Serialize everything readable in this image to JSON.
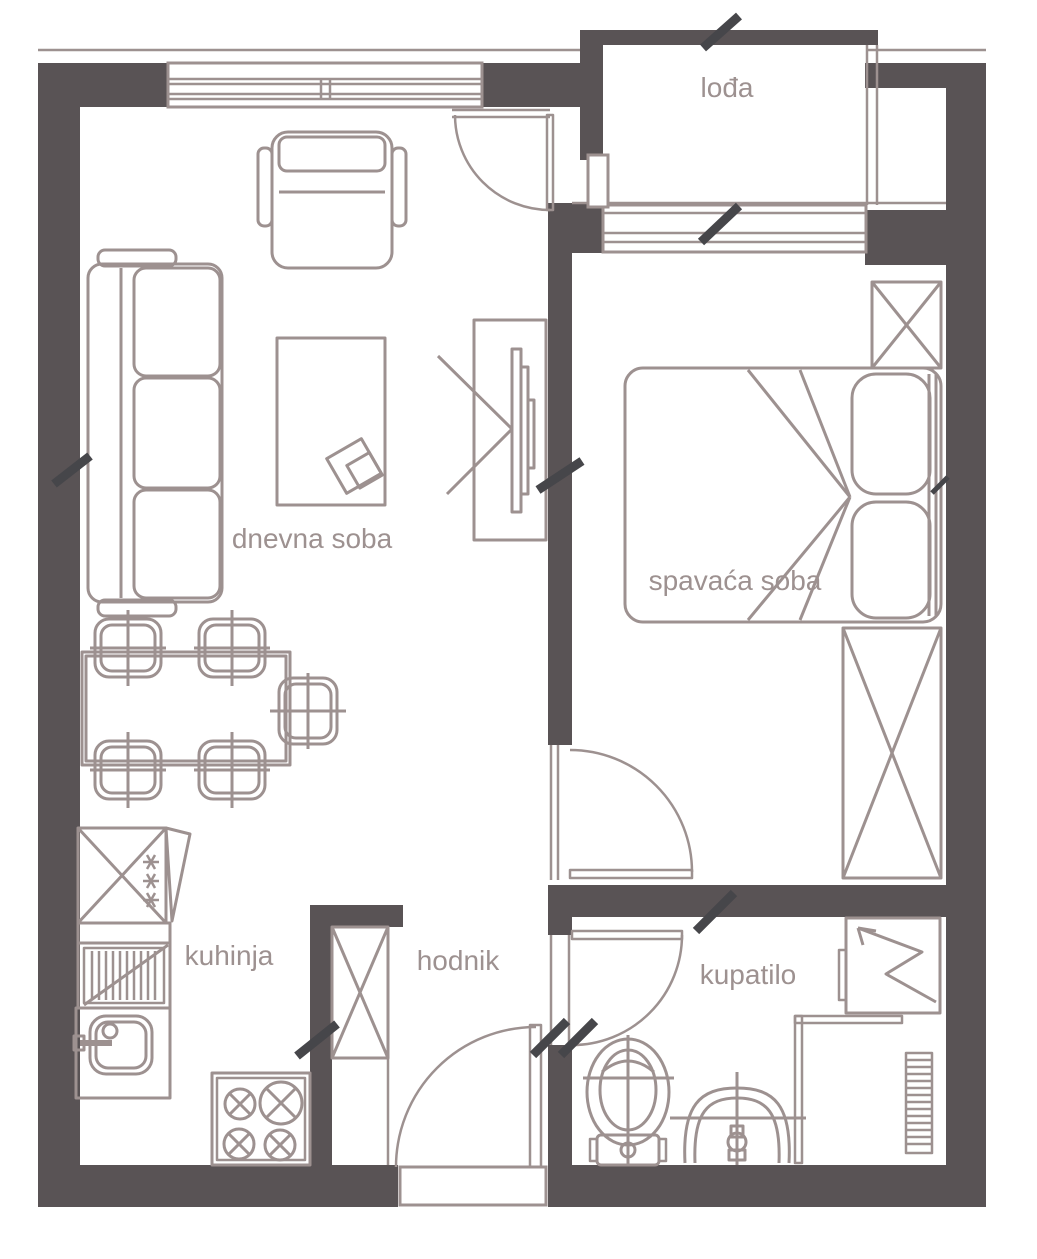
{
  "title": "apartment floor plan",
  "colors": {
    "wall": "#595355",
    "line": "#9d9190",
    "tick": "#46464a",
    "bg": "#ffffff"
  },
  "rooms": {
    "loggia": {
      "label": "lođa"
    },
    "living_room": {
      "label": "dnevna soba"
    },
    "bedroom": {
      "label": "spavaća soba"
    },
    "kitchen": {
      "label": "kuhinja"
    },
    "hallway": {
      "label": "hodnik"
    },
    "bathroom": {
      "label": "kupatilo"
    }
  }
}
